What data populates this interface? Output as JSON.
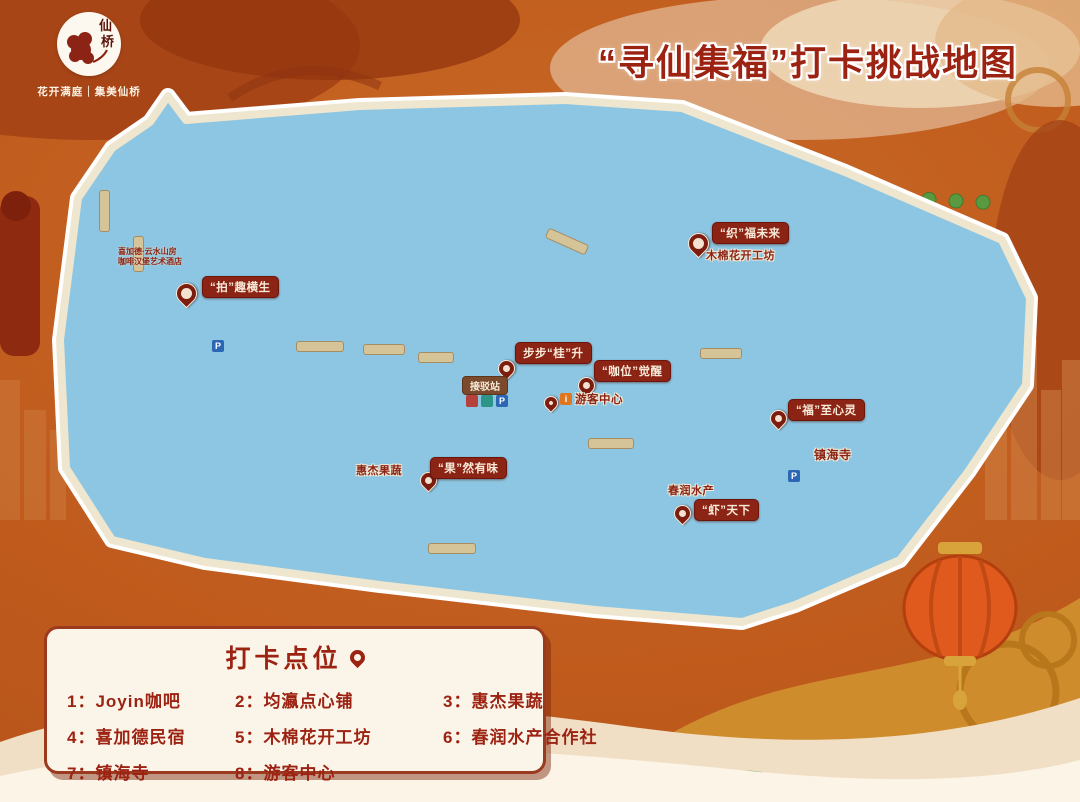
{
  "brand": {
    "logo_text": "仙桥",
    "tagline": "花开满庭｜集美仙桥"
  },
  "header": {
    "title": "“寻仙集福”打卡挑战地图"
  },
  "map": {
    "pin_labels": [
      {
        "text": "“拍”趣横生"
      },
      {
        "text": "“织”福未来"
      },
      {
        "text": "步步“桂”升"
      },
      {
        "text": "“咖位”觉醒"
      },
      {
        "text": "“福”至心灵"
      },
      {
        "text": "“果”然有味"
      },
      {
        "text": "“虾”天下"
      }
    ],
    "place_labels": {
      "workshop": "木棉花开工坊",
      "grocery": "惠杰果蔬",
      "aquafarm": "春润水产",
      "temple": "镇海寺",
      "visitor_center": "游客中心"
    },
    "signs": {
      "shuttle_station": "接驳站",
      "parking": "P",
      "info": "i"
    },
    "hotel_note": {
      "line1": "喜加德·云水山房",
      "line2": "咖啡汉堡艺术酒店"
    }
  },
  "legend": {
    "title": "打卡点位",
    "items": [
      {
        "num": "1：",
        "label": "Joyin咖吧"
      },
      {
        "num": "2：",
        "label": "均瀛点心铺"
      },
      {
        "num": "3：",
        "label": "惠杰果蔬"
      },
      {
        "num": "4：",
        "label": "喜加德民宿"
      },
      {
        "num": "5：",
        "label": "木棉花开工坊"
      },
      {
        "num": "6：",
        "label": "春润水产合作社"
      },
      {
        "num": "7：",
        "label": "镇海寺"
      },
      {
        "num": "8：",
        "label": "游客中心"
      }
    ]
  },
  "colors": {
    "background_orange": "#bf5a1c",
    "title_red": "#9c2212",
    "pin_red": "#7d1d10",
    "label_bg": "#8c2416",
    "legend_bg": "#fbf5e9",
    "map_green": "#7cb256",
    "river_blue": "#8cc6e2",
    "road_tan": "#d6c7a0"
  }
}
